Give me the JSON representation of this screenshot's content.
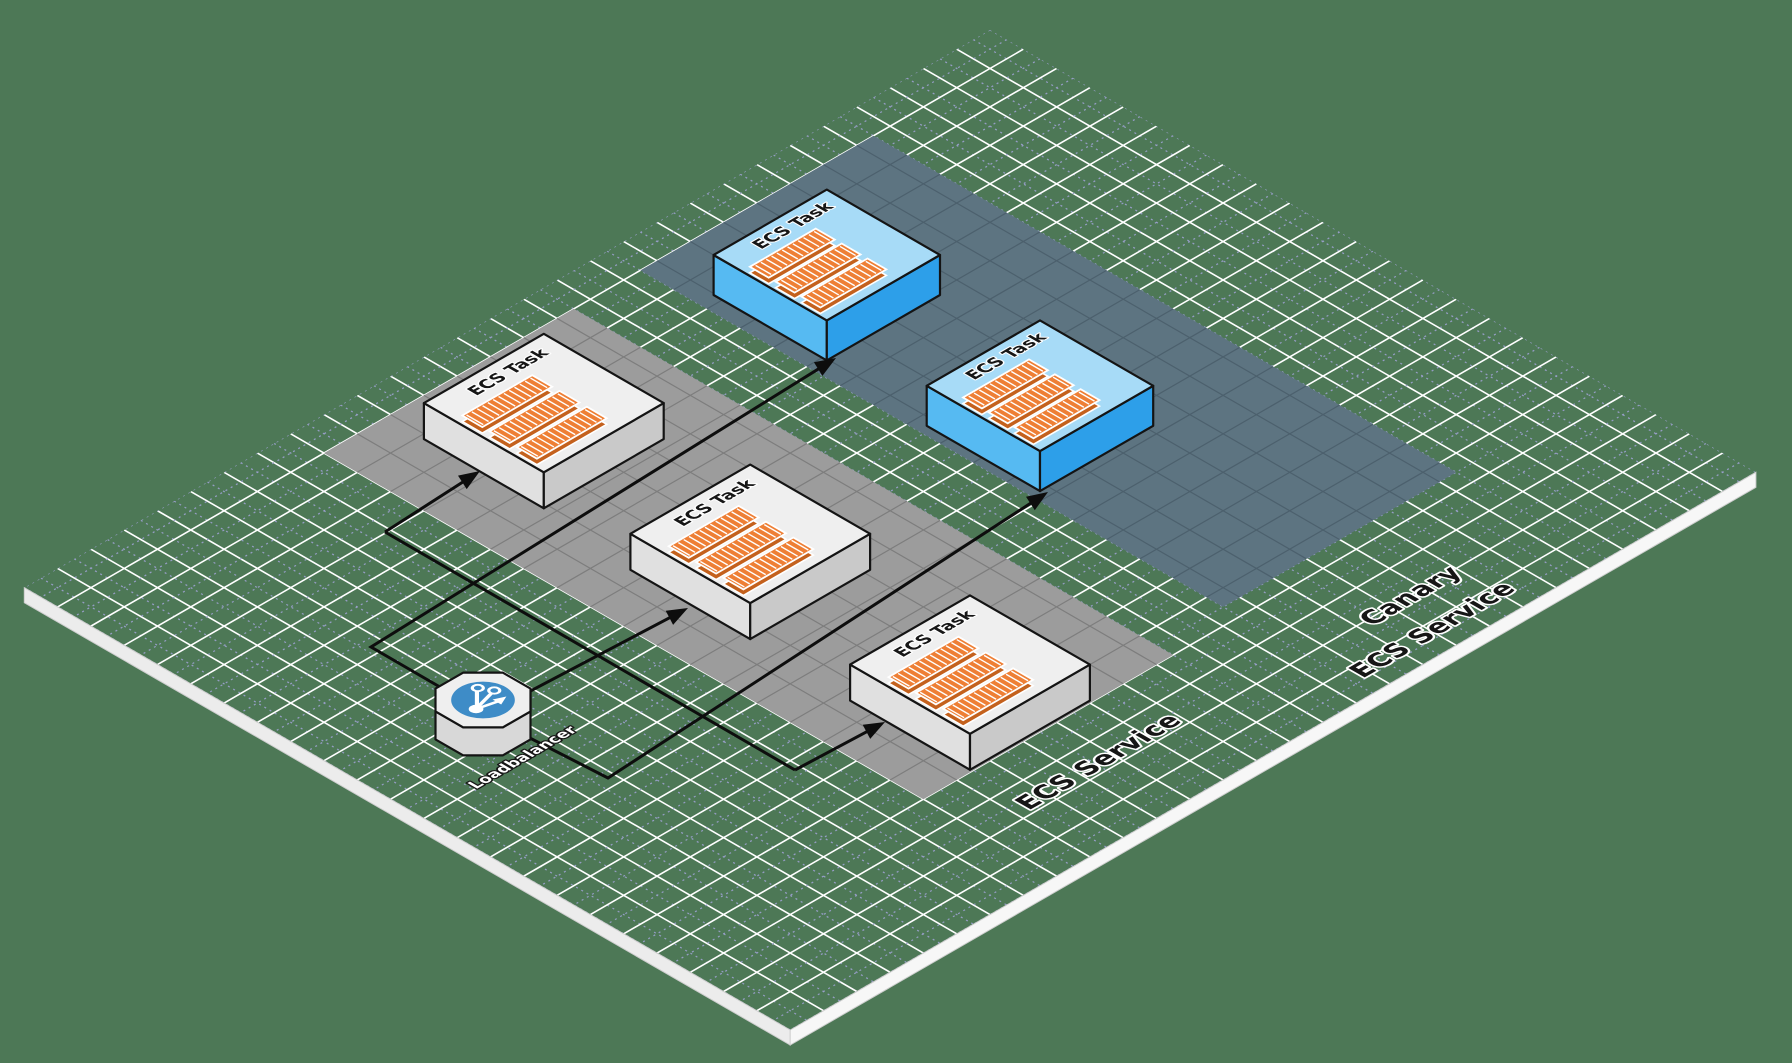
{
  "scene": {
    "title": "ECS canary deployment isometric diagram",
    "labels": {
      "task": "ECS Task",
      "loadbalancer": "Loadbalancer",
      "service": "ECS Service",
      "canary_line1": "Canary",
      "canary_line2": "ECS Service"
    },
    "colors": {
      "background": "#4d7856",
      "grid_major": "#ffffff",
      "grid_minor": "#9aa0cc",
      "zone_gray": "#9c9c9c",
      "zone_gray_line": "#7d7d7d",
      "zone_canary": "#5d7481",
      "zone_canary_line": "#4c606d",
      "edge_left": "#ececec",
      "edge_right": "#f7f7f7",
      "edge_line": "#cfcfcf",
      "connector": "#0d0d0d",
      "box_outline": "#141414",
      "white_box_top": "#efefef",
      "white_box_left": "#e0e0e0",
      "white_box_right": "#c9c9c9",
      "blue_box_top": "#a7dbf7",
      "blue_box_left": "#56baf2",
      "blue_box_right": "#2d9fe9",
      "container_fill": "#ee7f35",
      "container_dark": "#c4611d",
      "container_stripe": "#ffffff",
      "lb_top": "#efefef",
      "lb_side": "#d8d8d8",
      "lb_disc": "#3e8cc7",
      "label_dark": "#161616",
      "label_light": "#ffffff"
    },
    "grid": {
      "origin_x": 990,
      "origin_y": 30,
      "cell_w": 33.3,
      "cell_h": 19.23,
      "rows_i": 29,
      "cols_j": 23,
      "edge_depth": 15
    },
    "zones": [
      {
        "id": "ecs-service-zone",
        "i0": 13.5,
        "i1": 21,
        "j0": 1,
        "j1": 19,
        "fill": "zone_gray",
        "line": "zone_gray_line",
        "labels": [
          {
            "bind": "scene.labels.service",
            "x": 1106,
            "y": 766,
            "size": 26
          }
        ]
      },
      {
        "id": "canary-ecs-service-zone",
        "i0": 4.5,
        "i1": 11.5,
        "j0": 1,
        "j1": 18.5,
        "fill": "zone_canary",
        "line": "zone_canary_line",
        "labels": [
          {
            "bind": "scene.labels.canary_line1",
            "x": 1418,
            "y": 600,
            "size": 26
          },
          {
            "bind": "scene.labels.canary_line2",
            "x": 1440,
            "y": 634,
            "size": 26
          }
        ]
      }
    ],
    "tasks": [
      {
        "id": "ecs-task-1",
        "variant": "white",
        "i": 14.6,
        "j": 1.2,
        "side": 3.6,
        "height": 36
      },
      {
        "id": "ecs-task-2",
        "variant": "white",
        "i": 14.9,
        "j": 7.7,
        "side": 3.6,
        "height": 36
      },
      {
        "id": "ecs-task-3",
        "variant": "white",
        "i": 15.0,
        "j": 14.4,
        "side": 3.6,
        "height": 36
      },
      {
        "id": "canary-task-1",
        "variant": "blue",
        "i": 6.6,
        "j": 1.7,
        "side": 3.4,
        "height": 40
      },
      {
        "id": "canary-task-2",
        "variant": "blue",
        "i": 6.8,
        "j": 8.3,
        "side": 3.4,
        "height": 40
      }
    ],
    "loadbalancer": {
      "id": "loadbalancer",
      "cx": 483,
      "cy": 700,
      "radius": 42,
      "depth": 28,
      "label_x": 527,
      "label_y": 760,
      "label_size": 15.5
    },
    "connectors": [
      {
        "id": "lb-to-task2",
        "points": [
          [
            483,
            716
          ],
          [
            688,
            608
          ]
        ],
        "arrow": true
      },
      {
        "id": "trunk-line",
        "points": [
          [
            385,
            532
          ],
          [
            795,
            770
          ]
        ],
        "arrow": false
      },
      {
        "id": "branch-task1",
        "points": [
          [
            385,
            532
          ],
          [
            480,
            471
          ]
        ],
        "arrow": true
      },
      {
        "id": "branch-task3",
        "points": [
          [
            795,
            770
          ],
          [
            885,
            722
          ]
        ],
        "arrow": true
      },
      {
        "id": "lb-to-canary1",
        "points": [
          [
            483,
            712
          ],
          [
            371,
            647
          ],
          [
            836,
            358
          ]
        ],
        "arrow": true
      },
      {
        "id": "lb-to-canary2",
        "points": [
          [
            483,
            714
          ],
          [
            608,
            778
          ],
          [
            1048,
            492
          ]
        ],
        "arrow": true
      }
    ],
    "container_layout": {
      "i_from": 0.347,
      "i_to": 0.93,
      "j_starts": [
        0.25,
        0.478,
        0.706
      ],
      "j_width": 0.167,
      "stripe_step": 0.16
    },
    "task_label_offset": {
      "di": 0.425,
      "dj": 0.167,
      "size": 17
    }
  }
}
